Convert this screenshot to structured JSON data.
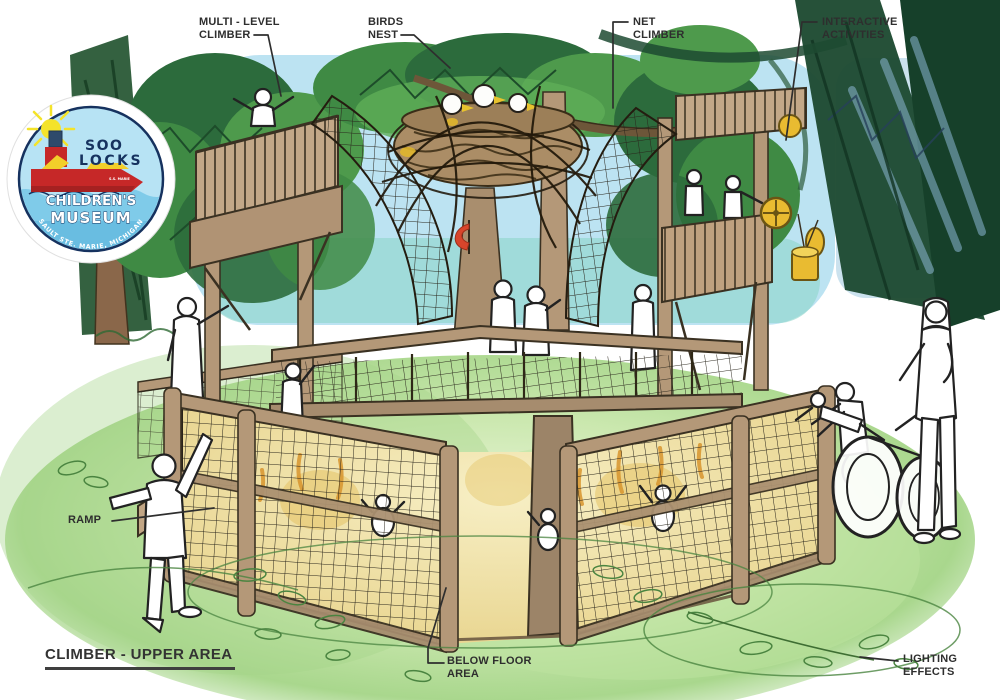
{
  "footer": {
    "title": "CLIMBER - UPPER AREA"
  },
  "logo": {
    "name_line1": "SOO",
    "name_line2": "LOCKS",
    "name_line3": "CHILDREN'S",
    "name_line4": "MUSEUM",
    "tagline": "SAULT STE. MARIE, MICHIGAN",
    "ship_label": "S.S. MARIE"
  },
  "annotations": {
    "multi_level_climber": {
      "line1": "MULTI - LEVEL",
      "line2": "CLIMBER"
    },
    "birds_nest": {
      "line1": "BIRDS",
      "line2": "NEST"
    },
    "net_climber": {
      "line1": "NET",
      "line2": "CLIMBER"
    },
    "interactive_activities": {
      "line1": "INTERACTIVE",
      "line2": "ACTIVITIES"
    },
    "ramp": {
      "line1": "RAMP"
    },
    "below_floor_area": {
      "line1": "BELOW FLOOR",
      "line2": "AREA"
    },
    "lighting_effects": {
      "line1": "LIGHTING",
      "line2": "EFFECTS"
    }
  },
  "icons": {
    "logo_sun": "sun-icon",
    "logo_ship": "ship-icon"
  },
  "colors": {
    "label_text": "#2e2e2e",
    "leader_line": "#2e2e2e",
    "title_underline": "#3f3f3f",
    "logo_navy": "#16325f",
    "logo_sky": "#b7e3f4",
    "logo_water": "#7fcbe9",
    "ship_red": "#c62828",
    "sun_yellow": "#f4e32a",
    "wood_tan": "#b49878",
    "net_line": "#29251b",
    "glow_yellow": "#f1e6ab",
    "lighting_orange": "#d8952e",
    "grass_green": "#4a8440",
    "canopy_green": "#2c6b3c",
    "sky_blue": "#b6e1f1"
  }
}
